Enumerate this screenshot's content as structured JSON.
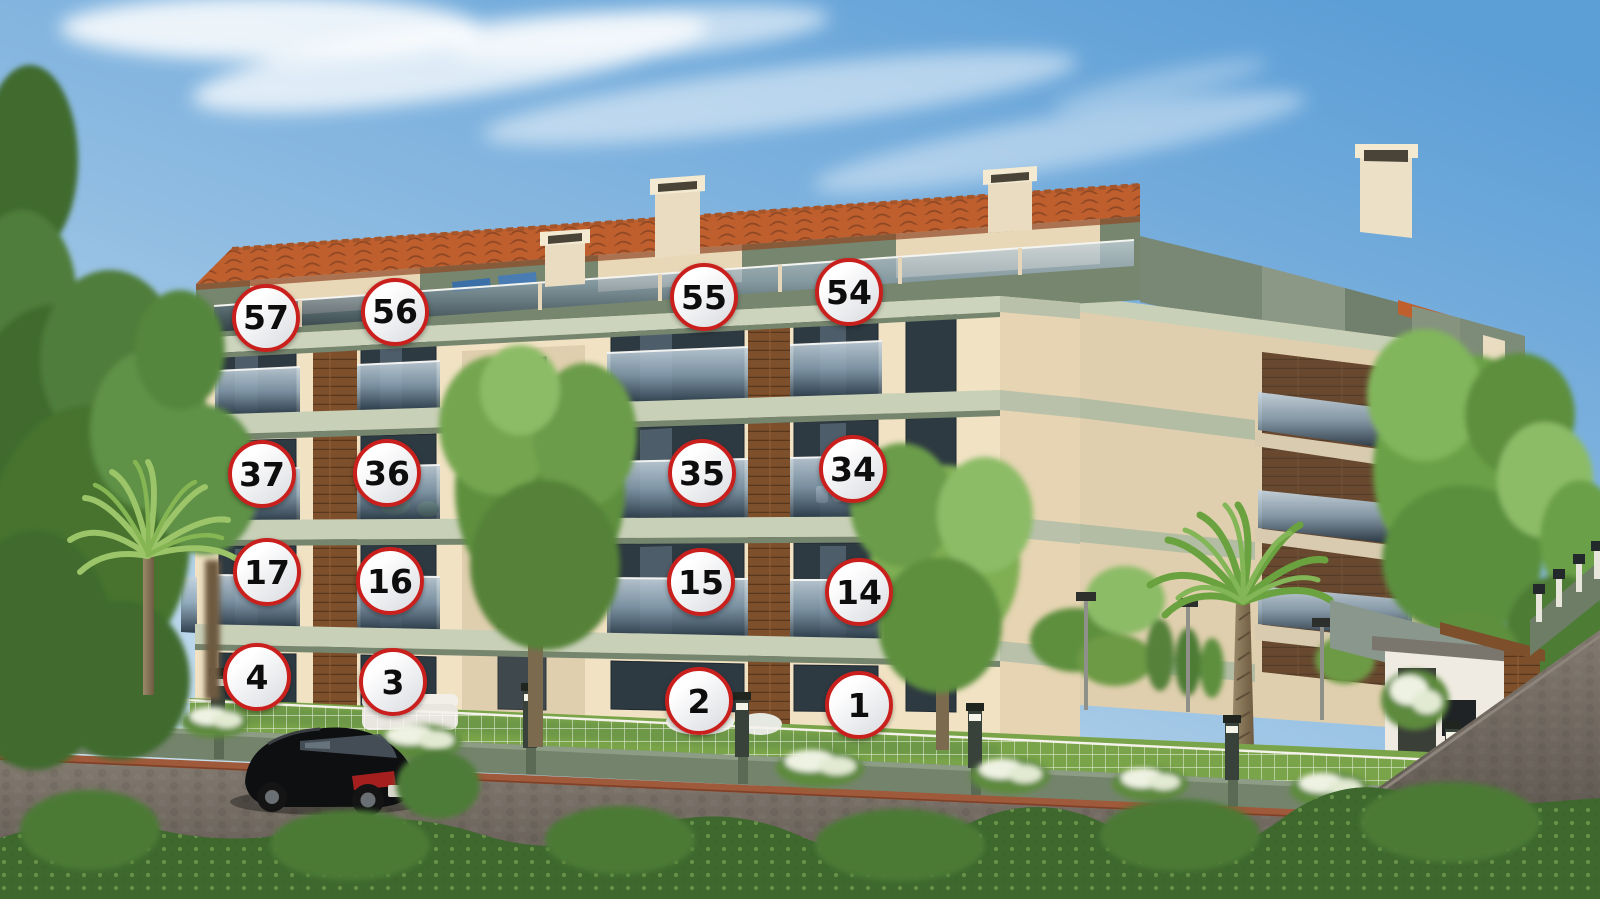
{
  "palette": {
    "sky_top": "#5c9ed6",
    "sky_mid": "#8fbce2",
    "sky_bottom": "#cfe3f0",
    "cloud": "#ffffff",
    "roof": "#bf5f2e",
    "roof_shadow": "#8e4724",
    "wall": "#f0e2c3",
    "wall_shadow": "#e0cfae",
    "trim": "#c9d0b8",
    "trim_shadow": "#76856e",
    "penthouse": "#76866f",
    "wood": "#7d4f2a",
    "wood_line": "#59371d",
    "window": "#2e3a42",
    "glass_top": "#c6d4de",
    "glass_bottom": "#1d2b38",
    "grass": "#7aa449",
    "foliage_dark": "#3f6a2e",
    "foliage": "#5d8f3d",
    "foliage_light": "#8cbc66",
    "hedge": "#3e682e",
    "fence_wall": "#74846c",
    "mesh": "#ffffff",
    "brick": "#9e5a3a",
    "road_light": "#82796f",
    "road_dark": "#5d564f",
    "car_body": "#0e0f11",
    "taillight": "#a51f1f",
    "badge_border": "#c9201d",
    "badge_fill_top": "#ffffff",
    "badge_fill_bottom": "#d9dbe0",
    "badge_text": "#0d0d0d"
  },
  "units": {
    "items": [
      {
        "label": "57",
        "x": 266,
        "y": 318
      },
      {
        "label": "56",
        "x": 395,
        "y": 312
      },
      {
        "label": "55",
        "x": 704,
        "y": 297
      },
      {
        "label": "54",
        "x": 849,
        "y": 292
      },
      {
        "label": "37",
        "x": 262,
        "y": 474
      },
      {
        "label": "36",
        "x": 387,
        "y": 473
      },
      {
        "label": "35",
        "x": 702,
        "y": 473
      },
      {
        "label": "34",
        "x": 853,
        "y": 469
      },
      {
        "label": "17",
        "x": 267,
        "y": 572
      },
      {
        "label": "16",
        "x": 390,
        "y": 581
      },
      {
        "label": "15",
        "x": 701,
        "y": 582
      },
      {
        "label": "14",
        "x": 859,
        "y": 592
      },
      {
        "label": "4",
        "x": 257,
        "y": 677
      },
      {
        "label": "3",
        "x": 393,
        "y": 682
      },
      {
        "label": "2",
        "x": 699,
        "y": 701
      },
      {
        "label": "1",
        "x": 859,
        "y": 705
      }
    ]
  }
}
